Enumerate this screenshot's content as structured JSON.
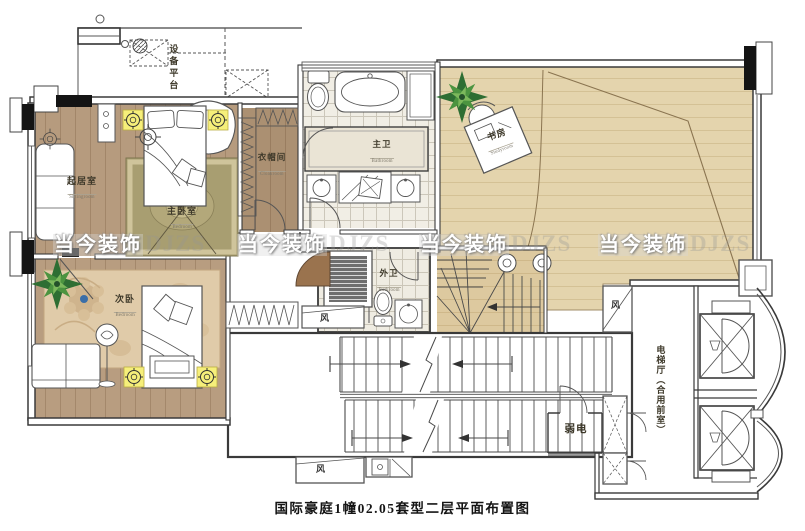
{
  "caption": "国际豪庭1幢02.05套型二层平面布置图",
  "watermark": {
    "text": "当今装饰",
    "latin": "DJZS"
  },
  "rooms": {
    "equipment_platform": {
      "zh": "设备平台"
    },
    "living_room": {
      "zh": "起居室",
      "en": "Sittingroom"
    },
    "master_bedroom": {
      "zh": "主卧室",
      "en": "Bedroom"
    },
    "cloakroom": {
      "zh": "衣帽间",
      "en": "Cloakroom"
    },
    "master_bath": {
      "zh": "主卫",
      "en": "Bathroom"
    },
    "study": {
      "zh": "书房",
      "en": "Studyroom"
    },
    "second_bedroom": {
      "zh": "次卧",
      "en": "Bedroom"
    },
    "guest_bath": {
      "zh": "外卫",
      "en": "Bathroom"
    },
    "elevator_hall": {
      "zh": "电梯厅（合用前室）"
    },
    "weak_current_room": {
      "zh": "弱电"
    },
    "vent_shaft": {
      "zh": "风"
    }
  },
  "colors": {
    "wood_dark": "#b69b7e",
    "wood_light": "#e4d4ad",
    "carpet_olive": "#a89e71",
    "carpet_tan": "#e0cba9",
    "spotlight_yellow": "#f6ef7a",
    "plant_green": "#2e6e33",
    "wall_line": "#3a3a3a"
  }
}
